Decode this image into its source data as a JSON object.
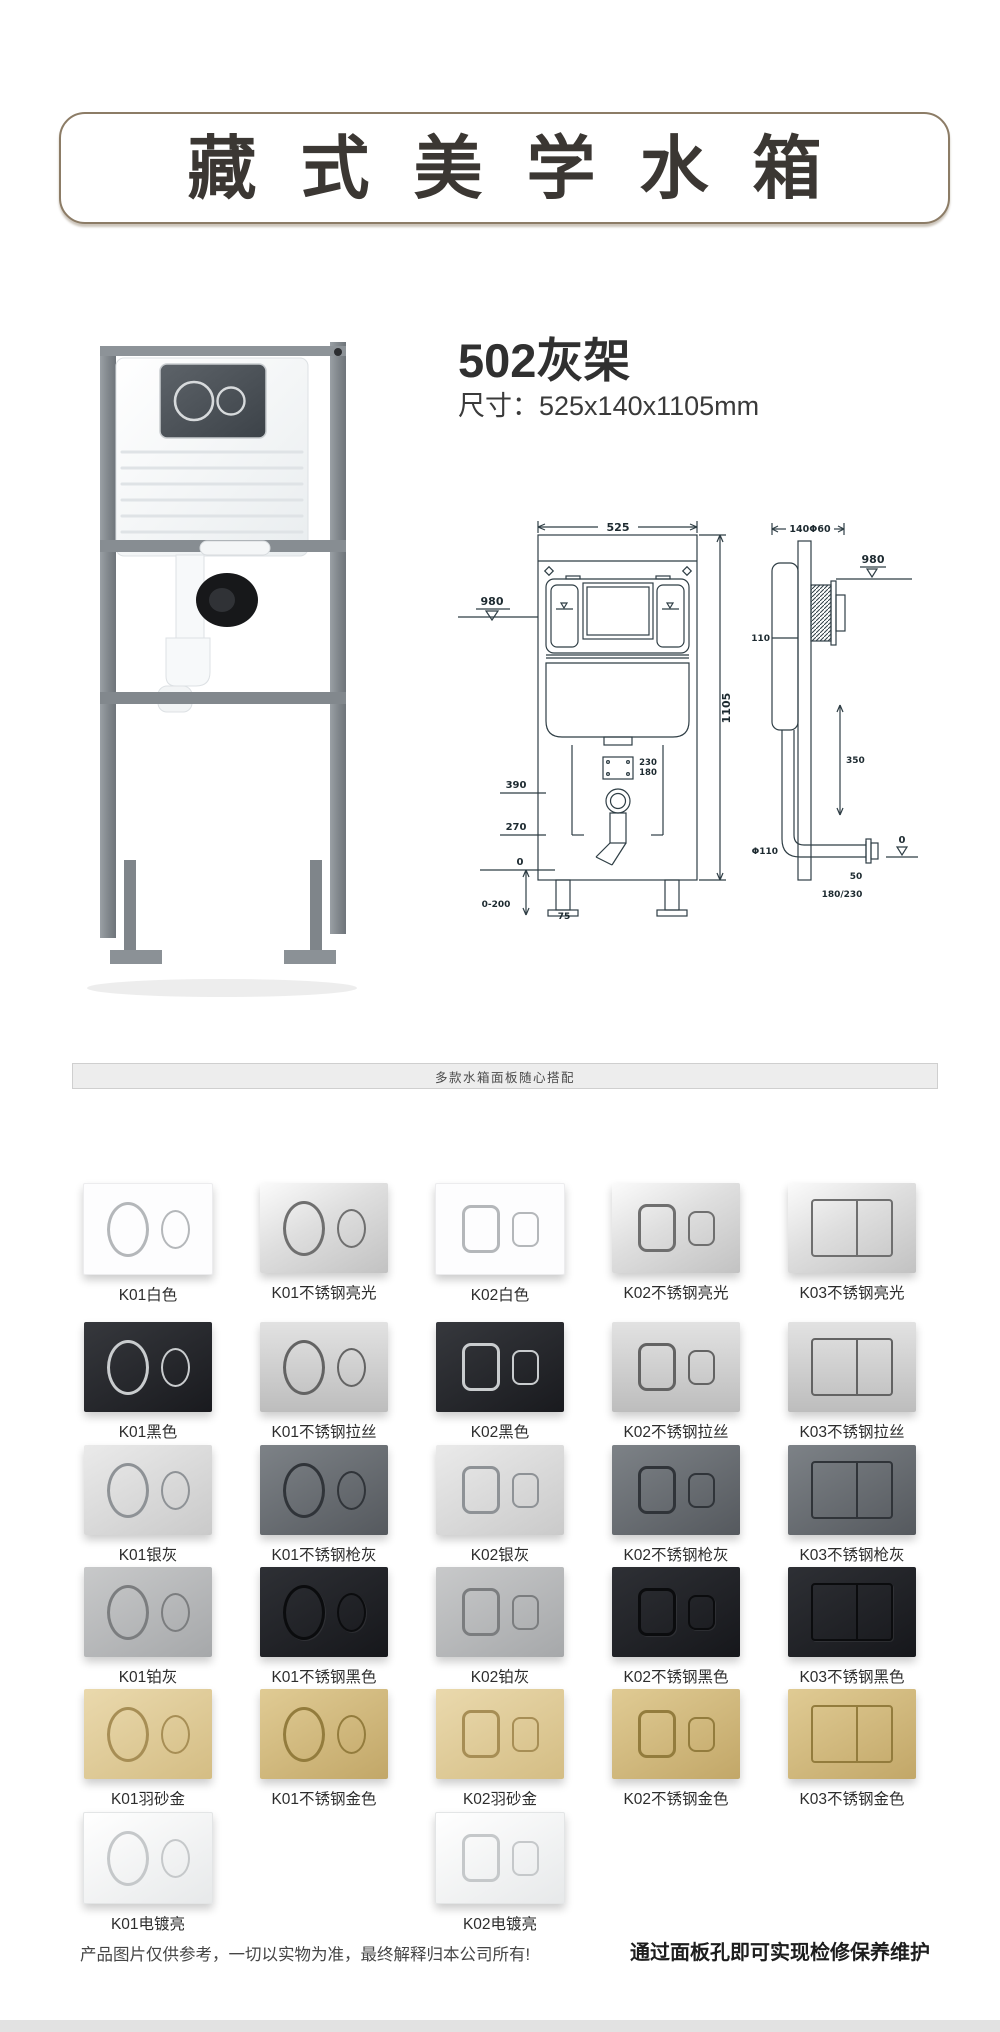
{
  "header": {
    "title": "藏式美学水箱"
  },
  "product": {
    "title": "502灰架",
    "dims": "尺寸：525x140x1105mm"
  },
  "drawing": {
    "front": {
      "w": "525",
      "h": "1105",
      "level": "980",
      "d390": "390",
      "d270": "270",
      "zero": "0",
      "range": "0-200",
      "angle": "75",
      "hole_a": "230",
      "hole_b": "180"
    },
    "side": {
      "depth": "140Φ60",
      "level": "980",
      "offset": "110",
      "drop": "350",
      "dia": "Φ110",
      "zero": "0",
      "d50": "50",
      "d180": "180/230"
    }
  },
  "banner": {
    "text": "多款水箱面板随心搭配"
  },
  "panels": {
    "rows": [
      {
        "items": [
          {
            "col": 0,
            "label": "K01白色",
            "type": "K01",
            "finish": "white"
          },
          {
            "col": 1,
            "label": "K01不锈钢亮光",
            "type": "K01",
            "finish": "steelbright"
          },
          {
            "col": 2,
            "label": "K02白色",
            "type": "K02",
            "finish": "white"
          },
          {
            "col": 3,
            "label": "K02不锈钢亮光",
            "type": "K02",
            "finish": "steelbright"
          },
          {
            "col": 4,
            "label": "K03不锈钢亮光",
            "type": "K03",
            "finish": "steelbright"
          }
        ]
      },
      {
        "items": [
          {
            "col": 0,
            "label": "K01黑色",
            "type": "K01",
            "finish": "blackchrome"
          },
          {
            "col": 1,
            "label": "K01不锈钢拉丝",
            "type": "K01",
            "finish": "brushed"
          },
          {
            "col": 2,
            "label": "K02黑色",
            "type": "K02",
            "finish": "blackchrome"
          },
          {
            "col": 3,
            "label": "K02不锈钢拉丝",
            "type": "K02",
            "finish": "brushed"
          },
          {
            "col": 4,
            "label": "K03不锈钢拉丝",
            "type": "K03",
            "finish": "brushed"
          }
        ]
      },
      {
        "items": [
          {
            "col": 0,
            "label": "K01银灰",
            "type": "K01",
            "finish": "silver"
          },
          {
            "col": 1,
            "label": "K01不锈钢枪灰",
            "type": "K01",
            "finish": "gun"
          },
          {
            "col": 2,
            "label": "K02银灰",
            "type": "K02",
            "finish": "silver"
          },
          {
            "col": 3,
            "label": "K02不锈钢枪灰",
            "type": "K02",
            "finish": "gun"
          },
          {
            "col": 4,
            "label": "K03不锈钢枪灰",
            "type": "K03",
            "finish": "gun"
          }
        ]
      },
      {
        "items": [
          {
            "col": 0,
            "label": "K01铂灰",
            "type": "K01",
            "finish": "platinum"
          },
          {
            "col": 1,
            "label": "K01不锈钢黑色",
            "type": "K01",
            "finish": "blackmatte"
          },
          {
            "col": 2,
            "label": "K02铂灰",
            "type": "K02",
            "finish": "platinum"
          },
          {
            "col": 3,
            "label": "K02不锈钢黑色",
            "type": "K02",
            "finish": "blackmatte"
          },
          {
            "col": 4,
            "label": "K03不锈钢黑色",
            "type": "K03",
            "finish": "blackmatte"
          }
        ]
      },
      {
        "items": [
          {
            "col": 0,
            "label": "K01羽砂金",
            "type": "K01",
            "finish": "goldfeather"
          },
          {
            "col": 1,
            "label": "K01不锈钢金色",
            "type": "K01",
            "finish": "goldsteel"
          },
          {
            "col": 2,
            "label": "K02羽砂金",
            "type": "K02",
            "finish": "goldfeather"
          },
          {
            "col": 3,
            "label": "K02不锈钢金色",
            "type": "K02",
            "finish": "goldsteel"
          },
          {
            "col": 4,
            "label": "K03不锈钢金色",
            "type": "K03",
            "finish": "goldsteel"
          }
        ]
      },
      {
        "items": [
          {
            "col": 0,
            "label": "K01电镀亮",
            "type": "K01",
            "finish": "chrome"
          },
          {
            "col": 2,
            "label": "K02电镀亮",
            "type": "K02",
            "finish": "chrome"
          }
        ]
      }
    ]
  },
  "footer": {
    "left": "产品图片仅供参考，一切以实物为准，最终解释归本公司所有!",
    "right": "通过面板孔即可实现检修保养维护"
  },
  "colors": {
    "header_border": "#8c7c66",
    "title_text": "#3b3733",
    "line": "#2f3e45",
    "banner_bg": "#ededed"
  }
}
